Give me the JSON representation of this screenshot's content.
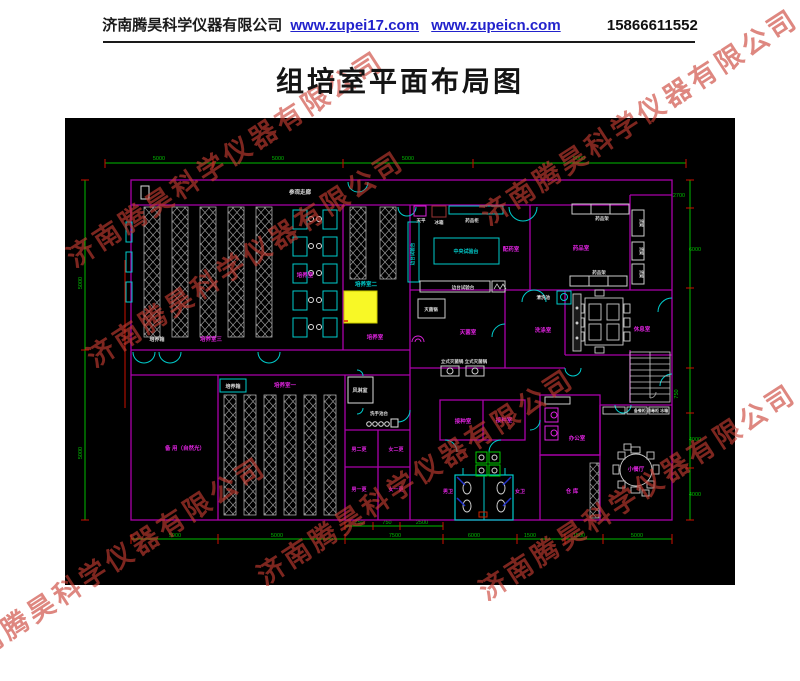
{
  "header": {
    "company": "济南腾昊科学仪器有限公司",
    "link1": "www.zupei17.com",
    "link2": "www.zupeicn.com",
    "phone": "15866611552"
  },
  "title": "组培室平面布局图",
  "watermark": "济南腾昊科学仪器有限公司",
  "colors": {
    "wall": "#aa00aa",
    "dimension": "#00bb00",
    "tick": "#cc1100",
    "fixture": "#00cccc",
    "label_magenta": "#dd22dd",
    "label_white": "#dddddd",
    "highlight": "#f8f826",
    "watermark_red": "#c93e32"
  },
  "plan": {
    "corridor": "参观走廊",
    "room3": "培养室三",
    "room3_small": "培养室",
    "incubator3": "培养箱",
    "room2": "培养室二",
    "room2_small": "培养室",
    "room1": "培养室一",
    "incubator1": "培养箱",
    "spare": "备 用（自然光）",
    "airshower": "风淋室",
    "washstand": "洗手池台",
    "chg_m2": "男二更",
    "chg_f2": "女二更",
    "chg_m1": "男一更",
    "chg_f1": "女一更",
    "inoc1": "接种室",
    "inoc2": "接种室",
    "wc_m": "男卫",
    "wc_f": "女卫",
    "office": "办公室",
    "store": "仓 库",
    "dining": "小餐厅",
    "rest": "休息室",
    "washroom": "洗涤室",
    "steril_room": "灭菌室",
    "sterilizer": "灭菌锅",
    "autoclaves": "立式灭菌锅 立式灭菌锅",
    "sink": "清洗池",
    "prep": "配药室",
    "med": "药品室",
    "bench_center": "中央试验台",
    "bench_side": "边台试验台",
    "bench_left": "边台试验台",
    "balance": "天平",
    "fridge": "冰箱",
    "med_cabinet": "药品柜",
    "shelf_top": "药品架",
    "shelf_bottom": "药品架",
    "cab1": "货架",
    "cab2": "货架",
    "cab3": "货架",
    "dining_cabs": "备餐柜 消毒柜 冰箱",
    "dims": {
      "top": [
        "5000",
        "5000",
        "5000",
        "5000"
      ],
      "bottom": [
        "5000",
        "5000",
        "7500",
        "6000",
        "1500",
        "1500",
        "5000"
      ],
      "bottom_inner": [
        "750",
        "750",
        "2500"
      ],
      "left": [
        "5000",
        "5000"
      ],
      "right": [
        "2700",
        "6000",
        "750",
        "4000",
        "4000"
      ]
    }
  }
}
